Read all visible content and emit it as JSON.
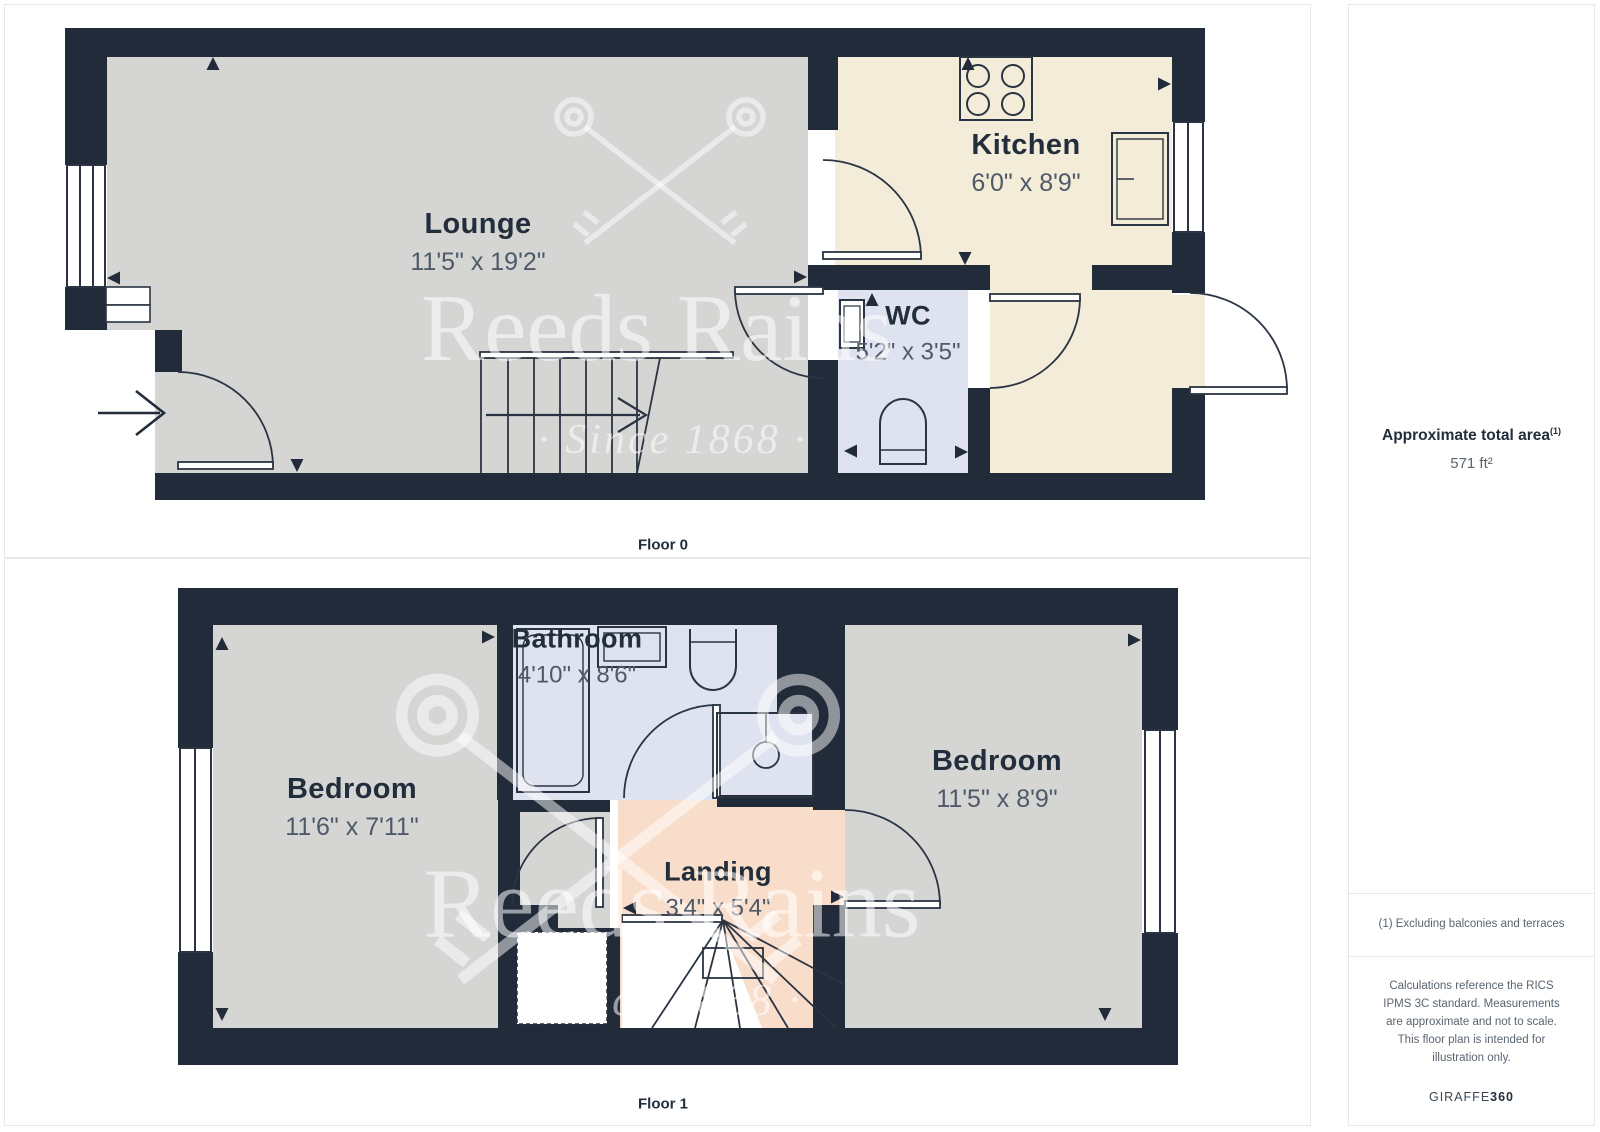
{
  "palette": {
    "wall": "#212b39",
    "line": "#2a3442",
    "room_gray": "#d5d5d4",
    "room_cream": "#f3ecd8",
    "room_blue": "#dfe3ef",
    "room_salmon": "#f8ddcb",
    "label_text": "#232e3c",
    "dim_text": "#4f5a68",
    "note_text": "#5a6470",
    "panel_border": "#e7e8ea"
  },
  "watermark": {
    "brand": "Reeds Rains",
    "tagline": "· Since 1868 ·"
  },
  "floors": [
    {
      "label": "Floor 0",
      "rooms": [
        {
          "name": "Lounge",
          "dims": "11'5\" x 19'2\""
        },
        {
          "name": "Kitchen",
          "dims": "6'0\" x 8'9\""
        },
        {
          "name": "WC",
          "dims": "5'2\" x 3'5\""
        }
      ]
    },
    {
      "label": "Floor 1",
      "rooms": [
        {
          "name": "Bedroom",
          "dims": "11'6\" x 7'11\""
        },
        {
          "name": "Bathroom",
          "dims": "4'10\" x 8'6\""
        },
        {
          "name": "Bedroom",
          "dims": "11'5\" x 8'9\""
        },
        {
          "name": "Landing",
          "dims": "3'4\" x 5'4\""
        }
      ]
    }
  ],
  "sidebar": {
    "total_area_label": "Approximate total area",
    "total_area_note_ref": "(1)",
    "total_area_value": "571 ft²",
    "footnote": "(1) Excluding balconies and terraces",
    "disclaimer": "Calculations reference the RICS IPMS 3C standard. Measurements are approximate and not to scale. This floor plan is intended for illustration only.",
    "brand": "GIRAFFE",
    "brand_suffix": "360"
  }
}
